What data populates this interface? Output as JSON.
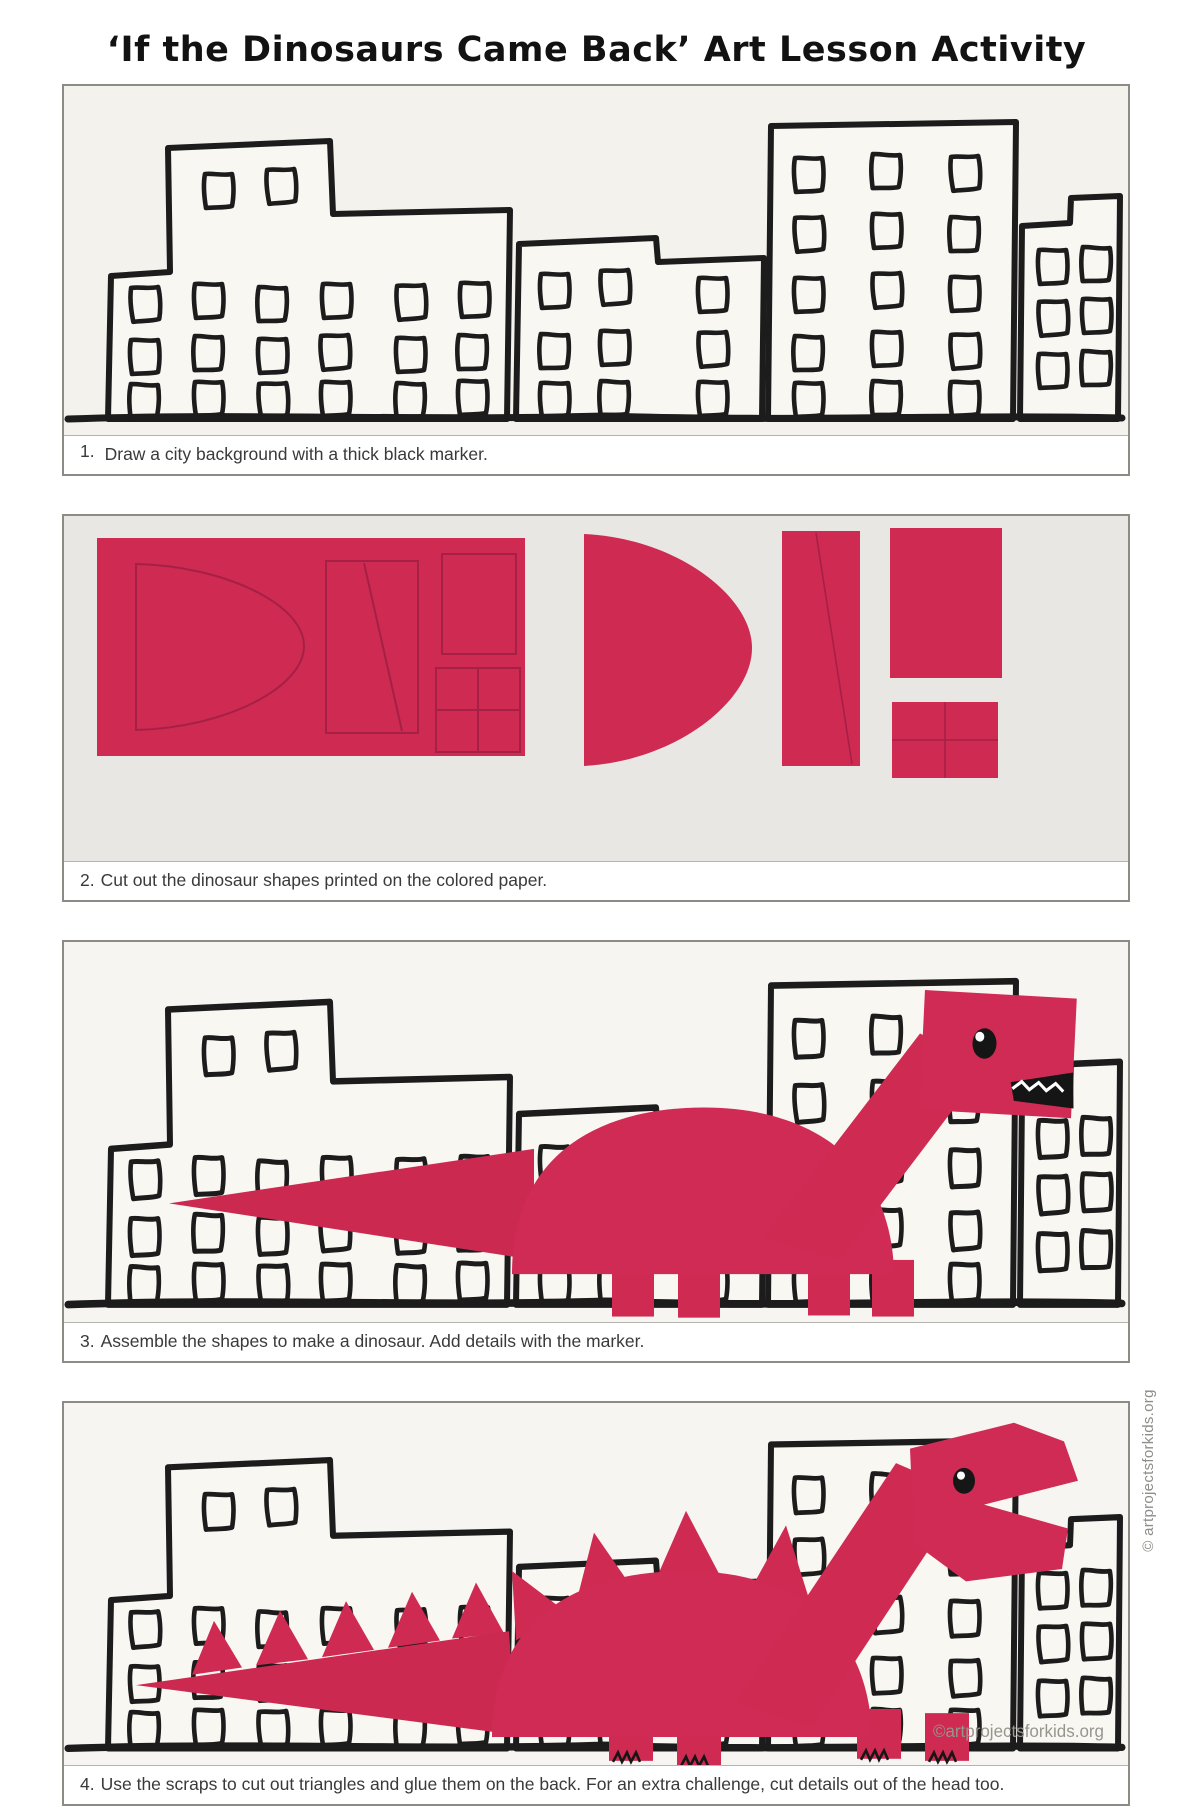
{
  "page": {
    "title": "‘If the Dinosaurs Came Back’ Art Lesson Activity",
    "side_credit": "© artprojectsforkids.org",
    "photo_watermark": "©artprojectsforkids.org"
  },
  "steps": [
    {
      "number": "1.",
      "text": "Draw a city background with a thick black marker."
    },
    {
      "number": "2.",
      "text": "Cut out the dinosaur shapes printed on the colored paper."
    },
    {
      "number": "3.",
      "text": "Assemble the shapes to make a dinosaur. Add details with the marker."
    },
    {
      "number": "4.",
      "text": "Use the scraps to cut out triangles and glue them on the back. For an extra challenge, cut details out of the head too."
    }
  ],
  "colors": {
    "paper_pink": "#ce2a52",
    "printed_outline": "#a62045",
    "marker_black": "#1c1c1c",
    "paper_white": "#f4f2ed",
    "mat_gray": "#e8e7e4",
    "caption_text": "#3a3a3a",
    "credit_gray": "#8f8d88"
  }
}
